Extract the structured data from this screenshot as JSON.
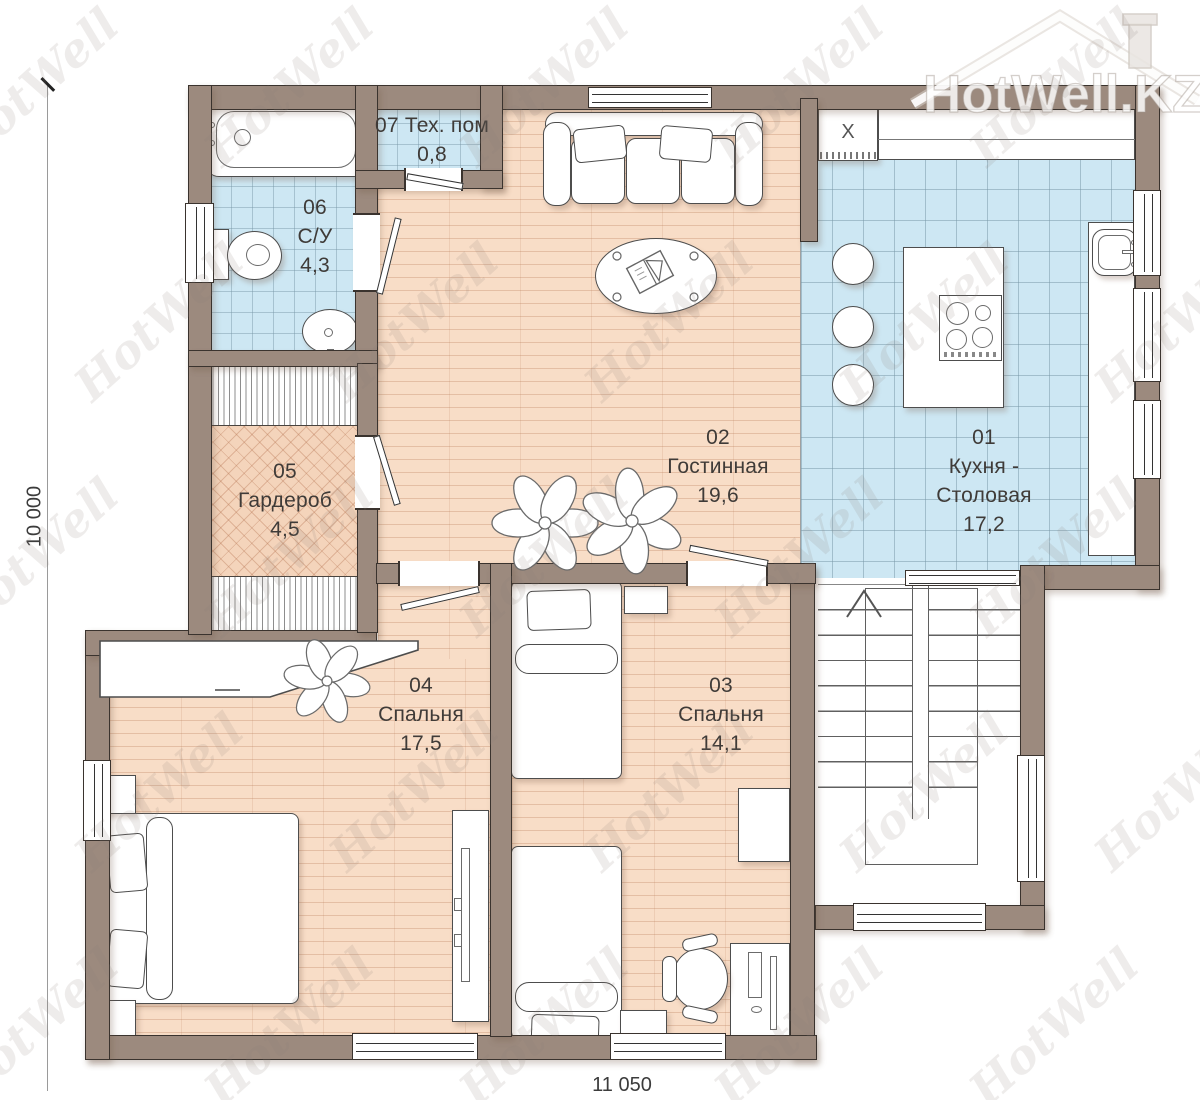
{
  "watermark": {
    "text": "HotWell",
    "brand": "HotWell.KZ"
  },
  "dimensions": {
    "vertical": "10 000",
    "horizontal": "11 050"
  },
  "rooms": [
    {
      "number": "01",
      "name": "Кухня - Столовая",
      "area": "17,2"
    },
    {
      "number": "02",
      "name": "Гостинная",
      "area": "19,6"
    },
    {
      "number": "03",
      "name": "Спальня",
      "area": "14,1"
    },
    {
      "number": "04",
      "name": "Спальня",
      "area": "17,5"
    },
    {
      "number": "05",
      "name": "Гардероб",
      "area": "4,5"
    },
    {
      "number": "06",
      "name": "С/У",
      "area": "4,3"
    },
    {
      "number": "07",
      "name": "Тех. пом",
      "area": "0,8"
    }
  ],
  "kitchen": {
    "appliance_mark": "X"
  },
  "colors": {
    "wall": "#9c8a7e",
    "tile": "#cde7f3",
    "wood": "#f8ddc7",
    "outline": "#3a332e"
  }
}
